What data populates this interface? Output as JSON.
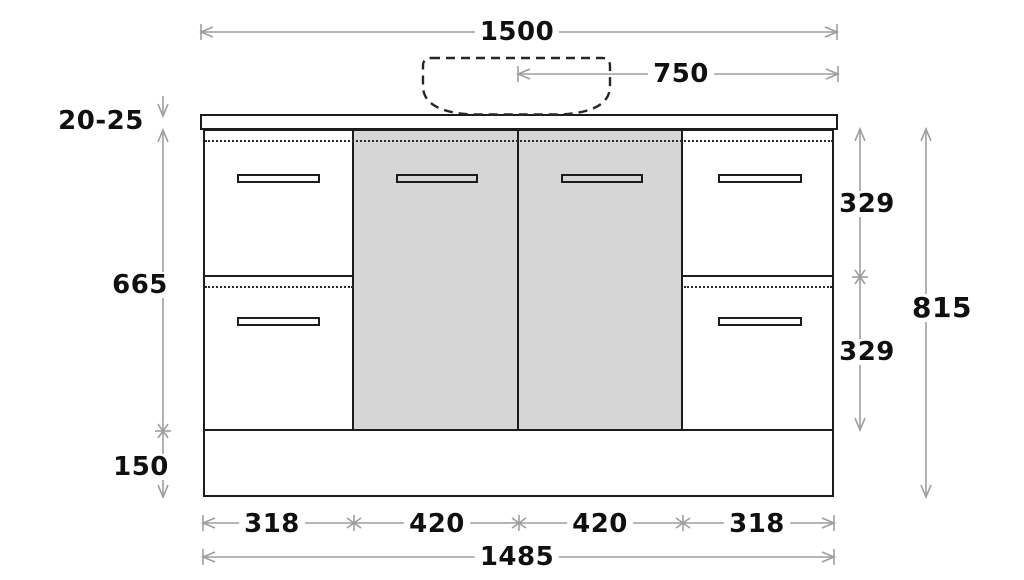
{
  "drawing": {
    "title": "Vanity cabinet dimension drawing",
    "top_dims": {
      "overall_width": "1500",
      "basin_center_to_edge": "750"
    },
    "left_dims": {
      "benchtop_thickness": "20-25",
      "cabinet_body_height": "665",
      "kickboard_height": "150"
    },
    "right_dims": {
      "top_drawer_height": "329",
      "bottom_drawer_height": "329",
      "overall_height": "815"
    },
    "bottom_dims": {
      "left_drawers_width": "318",
      "left_door_width": "420",
      "right_door_width": "420",
      "right_drawers_width": "318",
      "carcass_width": "1485"
    }
  },
  "colors": {
    "outline": "#1c1c1c",
    "door_fill": "#d5d6d5",
    "dimension_line": "#9e9e9e",
    "label_text": "#101010",
    "background": "#ffffff"
  }
}
